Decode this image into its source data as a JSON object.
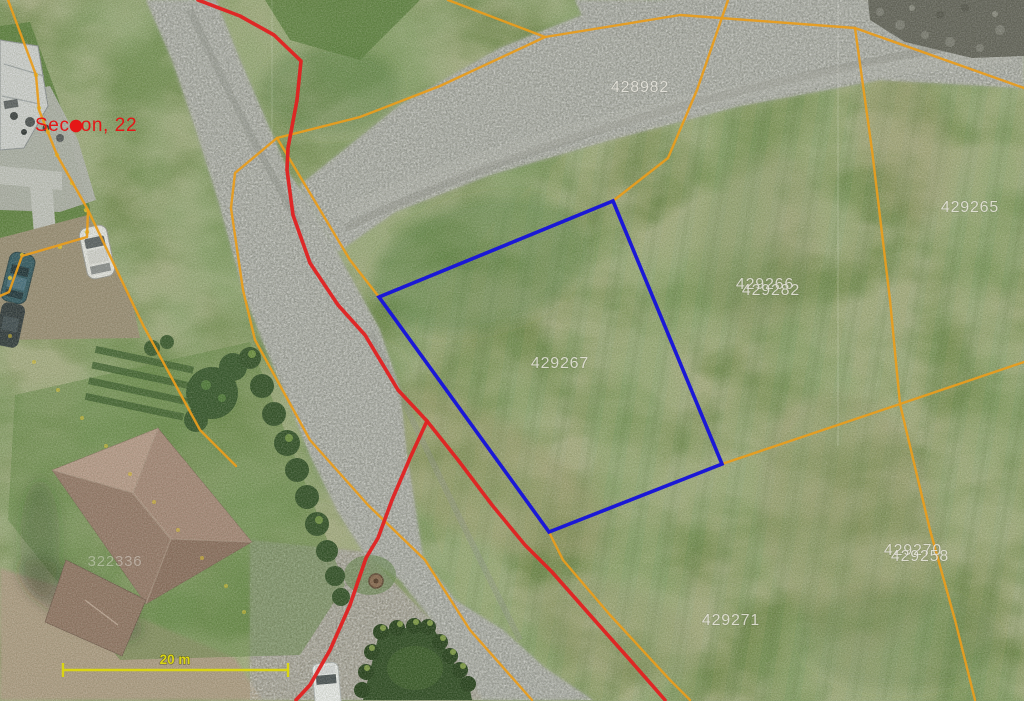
{
  "map": {
    "type": "aerial-orthophoto-cadastral-view",
    "selected_parcel": "429267",
    "parcel_labels": [
      {
        "text": "428982",
        "x": 640,
        "y": 92
      },
      {
        "text": "429265",
        "x": 970,
        "y": 212
      },
      {
        "text": "429266",
        "x": 765,
        "y": 289
      },
      {
        "text": "429282",
        "x": 771,
        "y": 295
      },
      {
        "text": "429267",
        "x": 560,
        "y": 368
      },
      {
        "text": "429270",
        "x": 913,
        "y": 555
      },
      {
        "text": "429258",
        "x": 920,
        "y": 561
      },
      {
        "text": "429271",
        "x": 731,
        "y": 625
      },
      {
        "text": "322336",
        "x": 115,
        "y": 566
      }
    ],
    "annotation": {
      "text": "Seceon, 22",
      "x": 35,
      "y": 131,
      "dot_x": 76,
      "dot_y": 126
    },
    "scale_bar": {
      "label": "20 m",
      "x1": 63,
      "x2": 288,
      "y": 670,
      "label_x": 175,
      "label_y": 664
    }
  },
  "colors": {
    "parcel_boundary": "#e89d1f",
    "restriction_line": "#e12222",
    "selected_parcel": "#1b18d6",
    "parcel_label": "#eceae2",
    "annotation": "#e51717",
    "scale_bar": "#d9d414"
  }
}
